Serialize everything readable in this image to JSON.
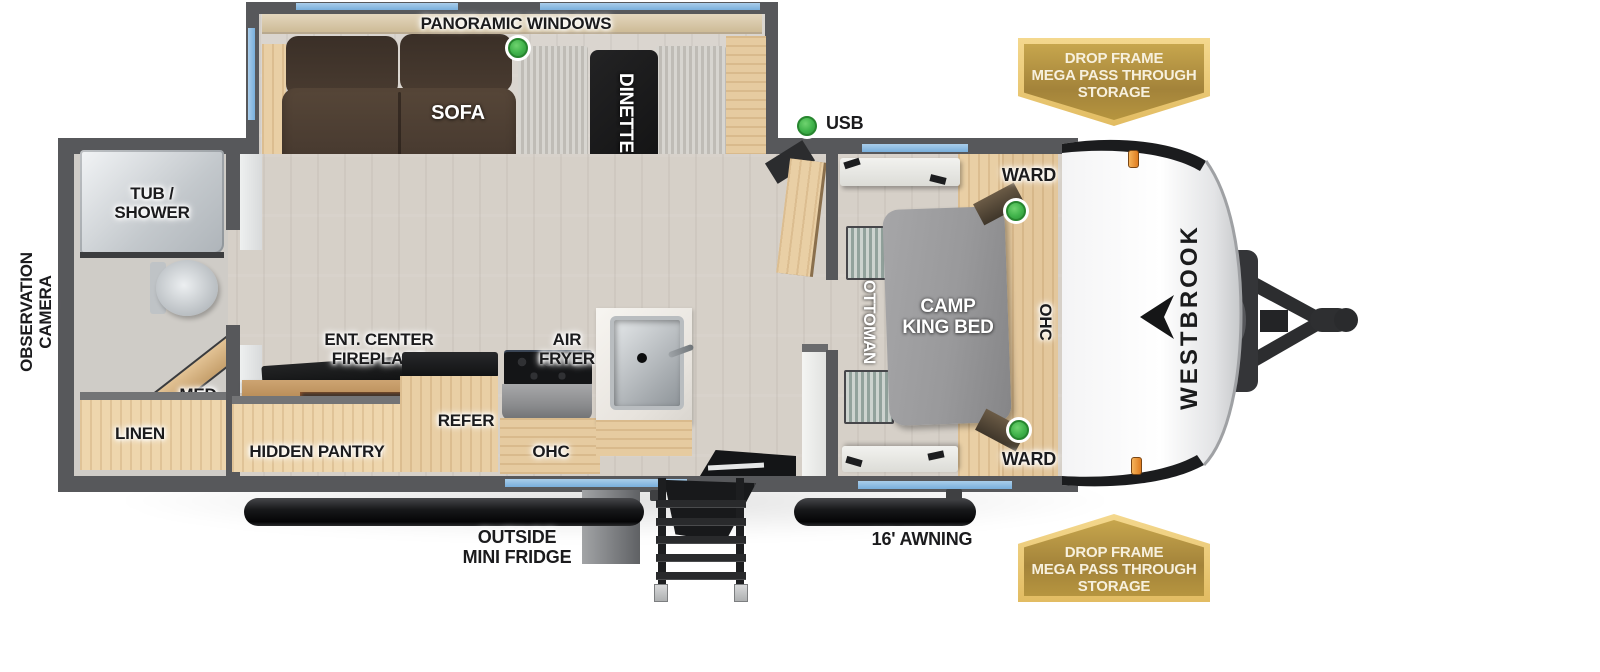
{
  "meta": {
    "title": "Westbrook travel trailer floorplan"
  },
  "labels": {
    "panoramic_windows": "PANORAMIC WINDOWS",
    "sofa": "SOFA",
    "dinette": "DINETTE",
    "usb": "USB",
    "ward": "WARD",
    "camp_king_bed": "CAMP\nKING BED",
    "ottoman": "OTTOMAN",
    "ohc": "OHC",
    "tub_shower": "TUB /\nSHOWER",
    "observation_camera": "OBSERVATION\nCAMERA",
    "med": "MED",
    "linen": "LINEN",
    "ent_center_fireplace": "ENT. CENTER\nFIREPLACE",
    "hidden_pantry": "HIDDEN PANTRY",
    "refer": "REFER",
    "air_fryer": "AIR\nFRYER",
    "outside_mini_fridge": "OUTSIDE\nMINI FRIDGE",
    "awning": "16' AWNING",
    "brand": "WESTBROOK",
    "storage_badge": "DROP FRAME\nMEGA PASS THROUGH\nSTORAGE"
  },
  "colors": {
    "wall": "#57585b",
    "window_blue": "#79afdc",
    "marker_green": "#3fb24a",
    "badge_gold": "#c7a64d",
    "badge_border": "#f0cd7e",
    "wood": "#e9cfa5",
    "sofa_brown": "#4c3e34",
    "bed_gray": "#9c9c9e",
    "marker_light_orange": "#e78a2e"
  }
}
